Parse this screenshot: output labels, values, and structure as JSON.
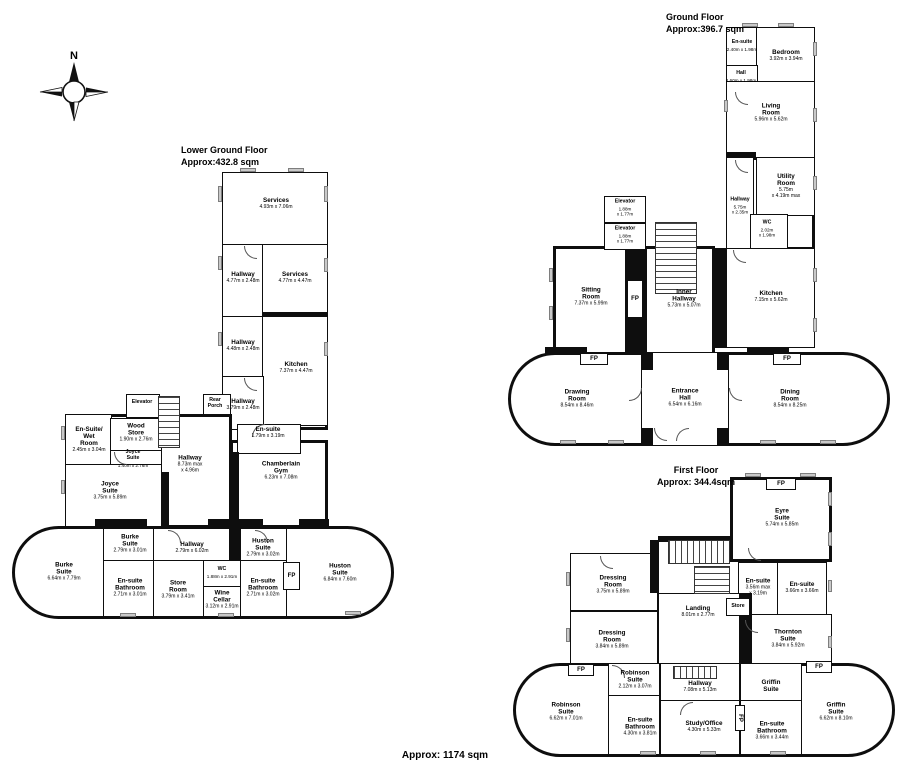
{
  "footer": {
    "total_area": "Approx: 1174 sqm"
  },
  "compass": {
    "north_label": "N"
  },
  "floors": {
    "lower": {
      "title": "Lower Ground Floor",
      "area": "Approx:432.8 sqm",
      "rooms": [
        {
          "name": "Services",
          "dims": "4.93m x 7.06m",
          "x": 276,
          "y": 204
        },
        {
          "name": "Hallway",
          "dims": "4.77m x 2.48m",
          "x": 243,
          "y": 278
        },
        {
          "name": "Services",
          "dims": "4.77m x 4.47m",
          "x": 295,
          "y": 278
        },
        {
          "name": "Hallway",
          "dims": "4.48m x 2.48m",
          "x": 243,
          "y": 346
        },
        {
          "name": "Kitchen",
          "dims": "7.37m x 4.47m",
          "x": 296,
          "y": 368
        },
        {
          "name": "Hallway",
          "dims": "3.79m x 2.48m",
          "x": 243,
          "y": 405
        },
        {
          "name": "Rear\nPorch",
          "dims": null,
          "x": 215,
          "y": 404,
          "small": true
        },
        {
          "name": "Elevator",
          "dims": null,
          "x": 142,
          "y": 403,
          "small": true
        },
        {
          "name": "En-suite",
          "dims": "1.79m x 3.19m",
          "x": 268,
          "y": 433
        },
        {
          "name": "Wood\nStore",
          "dims": "1.90m x 2.76m",
          "x": 136,
          "y": 433
        },
        {
          "name": "En-Suite/\nWet\nRoom",
          "dims": "2.45m x 3.04m",
          "x": 89,
          "y": 440
        },
        {
          "name": "Joyce\nSuite",
          "dims": "1.40m x 2.76m",
          "x": 133,
          "y": 459,
          "small": true
        },
        {
          "name": "Joyce\nSuite",
          "dims": "3.75m x 5.89m",
          "x": 110,
          "y": 491
        },
        {
          "name": "Hallway",
          "dims": "8.73m max\nx 4.96m",
          "x": 190,
          "y": 464
        },
        {
          "name": "Chamberlain\nGym",
          "dims": "6.23m x 7.08m",
          "x": 281,
          "y": 471
        },
        {
          "name": "Burke\nSuite",
          "dims": "2.79m x 3.01m",
          "x": 130,
          "y": 544
        },
        {
          "name": "Hallway",
          "dims": "2.79m x 6.02m",
          "x": 192,
          "y": 548
        },
        {
          "name": "Huston\nSuite",
          "dims": "2.79m x 3.02m",
          "x": 263,
          "y": 548
        },
        {
          "name": "Burke\nSuite",
          "dims": "6.64m x 7.79m",
          "x": 64,
          "y": 572
        },
        {
          "name": "En-suite\nBathroom",
          "dims": "2.71m x 3.01m",
          "x": 130,
          "y": 588
        },
        {
          "name": "Store\nRoom",
          "dims": "3.79m x 3.41m",
          "x": 178,
          "y": 590
        },
        {
          "name": "WC",
          "dims": "1.88m x 2.91m",
          "x": 222,
          "y": 573,
          "small": true
        },
        {
          "name": "Wine\nCellar",
          "dims": "3.12m x 2.91m",
          "x": 222,
          "y": 600
        },
        {
          "name": "En-suite\nBathroom",
          "dims": "2.71m x 3.02m",
          "x": 263,
          "y": 588
        },
        {
          "name": "Huston\nSuite",
          "dims": "6.84m x 7.60m",
          "x": 340,
          "y": 573
        }
      ],
      "fireplaces": [
        {
          "label": "FP",
          "x": 283,
          "y": 562,
          "w": 17,
          "h": 28
        }
      ]
    },
    "ground": {
      "title": "Ground Floor",
      "area": "Approx:396.7 sqm",
      "rooms": [
        {
          "name": "En-suite",
          "dims": "2.40m x 1.98m",
          "x": 742,
          "y": 46,
          "small": true
        },
        {
          "name": "Bedroom",
          "dims": "3.92m x 3.94m",
          "x": 786,
          "y": 56
        },
        {
          "name": "Hall",
          "dims": "2.60m x 1.98m",
          "x": 741,
          "y": 77,
          "small": true
        },
        {
          "name": "Living\nRoom",
          "dims": "5.96m x 5.62m",
          "x": 771,
          "y": 113
        },
        {
          "name": "Utility\nRoom",
          "dims": "5.75m\nx 4.19m max",
          "x": 786,
          "y": 186
        },
        {
          "name": "Hallway",
          "dims": "5.75m\nx 2.35m",
          "x": 740,
          "y": 206,
          "small": true
        },
        {
          "name": "WC",
          "dims": "2.02m\nx 1.98m",
          "x": 767,
          "y": 229,
          "small": true
        },
        {
          "name": "Kitchen",
          "dims": "7.15m x 5.62m",
          "x": 771,
          "y": 297
        },
        {
          "name": "Sitting\nRoom",
          "dims": "7.37m x 5.99m",
          "x": 591,
          "y": 297
        },
        {
          "name": "Elevator",
          "dims": "1.88m\nx 1.77m",
          "x": 625,
          "y": 208,
          "small": true
        },
        {
          "name": "Elevator",
          "dims": "1.88m\nx 1.77m",
          "x": 625,
          "y": 235,
          "small": true
        },
        {
          "name": "Inner\nHallway",
          "dims": "5.73m x 5.07m",
          "x": 684,
          "y": 299
        },
        {
          "name": "Drawing\nRoom",
          "dims": "8.54m x 8.46m",
          "x": 577,
          "y": 399
        },
        {
          "name": "Entrance\nHall",
          "dims": "6.54m x 6.16m",
          "x": 685,
          "y": 398
        },
        {
          "name": "Dining\nRoom",
          "dims": "8.54m x 8.25m",
          "x": 790,
          "y": 399
        }
      ],
      "fireplaces": [
        {
          "label": "FP",
          "x": 627,
          "y": 280,
          "w": 16,
          "h": 38
        },
        {
          "label": "FP",
          "x": 580,
          "y": 353,
          "w": 28,
          "h": 12
        },
        {
          "label": "FP",
          "x": 773,
          "y": 353,
          "w": 28,
          "h": 12
        }
      ]
    },
    "first": {
      "title": "First Floor",
      "area": "Approx: 344.4sqm",
      "rooms": [
        {
          "name": "Eyre\nSuite",
          "dims": "5.74m x 5.85m",
          "x": 782,
          "y": 518
        },
        {
          "name": "Dressing\nRoom",
          "dims": "3.75m x 5.89m",
          "x": 613,
          "y": 585
        },
        {
          "name": "Dressing\nRoom",
          "dims": "3.84m x 5.89m",
          "x": 612,
          "y": 640
        },
        {
          "name": "En-suite",
          "dims": "3.56m max\nx 3.19m",
          "x": 758,
          "y": 587
        },
        {
          "name": "En-suite",
          "dims": "3.66m x 3.66m",
          "x": 802,
          "y": 588
        },
        {
          "name": "Store",
          "dims": null,
          "x": 738,
          "y": 607,
          "small": true
        },
        {
          "name": "Landing",
          "dims": "8.01m x 2.77m",
          "x": 698,
          "y": 612
        },
        {
          "name": "Thornton\nSuite",
          "dims": "3.84m x 5.92m",
          "x": 788,
          "y": 639
        },
        {
          "name": "Robinson\nSuite",
          "dims": "2.12m x 3.07m",
          "x": 635,
          "y": 680
        },
        {
          "name": "Hallway",
          "dims": "7.08m x 5.13m",
          "x": 700,
          "y": 687
        },
        {
          "name": "Griffin\nSuite",
          "dims": null,
          "x": 771,
          "y": 686
        },
        {
          "name": "Robinson\nSuite",
          "dims": "6.62m x 7.01m",
          "x": 566,
          "y": 712
        },
        {
          "name": "En-suite\nBathroom",
          "dims": "4.30m x 3.81m",
          "x": 640,
          "y": 727
        },
        {
          "name": "Study/Office",
          "dims": "4.30m x 5.33m",
          "x": 704,
          "y": 727
        },
        {
          "name": "En-suite\nBathroom",
          "dims": "3.66m x 3.44m",
          "x": 772,
          "y": 731
        },
        {
          "name": "Griffin\nSuite",
          "dims": "6.62m x 8.10m",
          "x": 836,
          "y": 712
        }
      ],
      "fireplaces": [
        {
          "label": "FP",
          "x": 766,
          "y": 478,
          "w": 30,
          "h": 12
        },
        {
          "label": "FP",
          "x": 568,
          "y": 664,
          "w": 26,
          "h": 12
        },
        {
          "label": "FP",
          "x": 806,
          "y": 661,
          "w": 26,
          "h": 12
        },
        {
          "label": "FP",
          "x": 735,
          "y": 705,
          "w": 10,
          "h": 26,
          "vert": true
        }
      ]
    }
  }
}
